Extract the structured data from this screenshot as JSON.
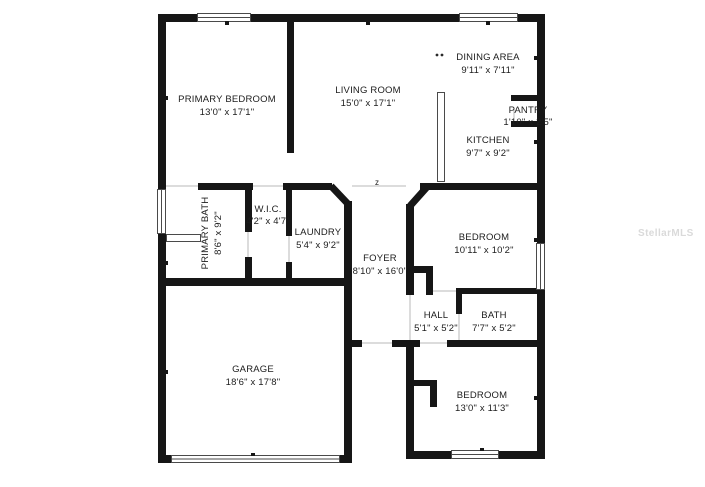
{
  "title": "Floor plan",
  "colors": {
    "wall": "#161616",
    "label_text": "#1c1c1c",
    "background": "#ffffff",
    "watermark": "#dadada"
  },
  "watermark": "StellarMLS",
  "markers": {
    "foyer_note": "z"
  },
  "rooms": {
    "primary_bedroom": {
      "name": "PRIMARY BEDROOM",
      "dims": "13'0\" x 17'1\""
    },
    "living_room": {
      "name": "LIVING ROOM",
      "dims": "15'0\" x 17'1\""
    },
    "dining_area": {
      "name": "DINING AREA",
      "dims": "9'11\" x 7'11\""
    },
    "pantry": {
      "name": "PANTRY",
      "dims": "1'10\" x 2'5\""
    },
    "kitchen": {
      "name": "KITCHEN",
      "dims": "9'7\" x 9'2\""
    },
    "primary_bath": {
      "name": "PRIMARY BATH",
      "dims": "8'6\" x 9'2\""
    },
    "wic": {
      "name": "W.I.C.",
      "dims": "4'2\" x 4'7\""
    },
    "laundry": {
      "name": "LAUNDRY",
      "dims": "5'4\" x 9'2\""
    },
    "foyer": {
      "name": "FOYER",
      "dims": "8'10\" x 16'0\""
    },
    "bedroom1": {
      "name": "BEDROOM",
      "dims": "10'11\" x 10'2\""
    },
    "hall": {
      "name": "HALL",
      "dims": "5'1\" x 5'2\""
    },
    "bath": {
      "name": "BATH",
      "dims": "7'7\" x 5'2\""
    },
    "garage": {
      "name": "GARAGE",
      "dims": "18'6\" x 17'8\""
    },
    "bedroom2": {
      "name": "BEDROOM",
      "dims": "13'0\" x 11'3\""
    }
  }
}
